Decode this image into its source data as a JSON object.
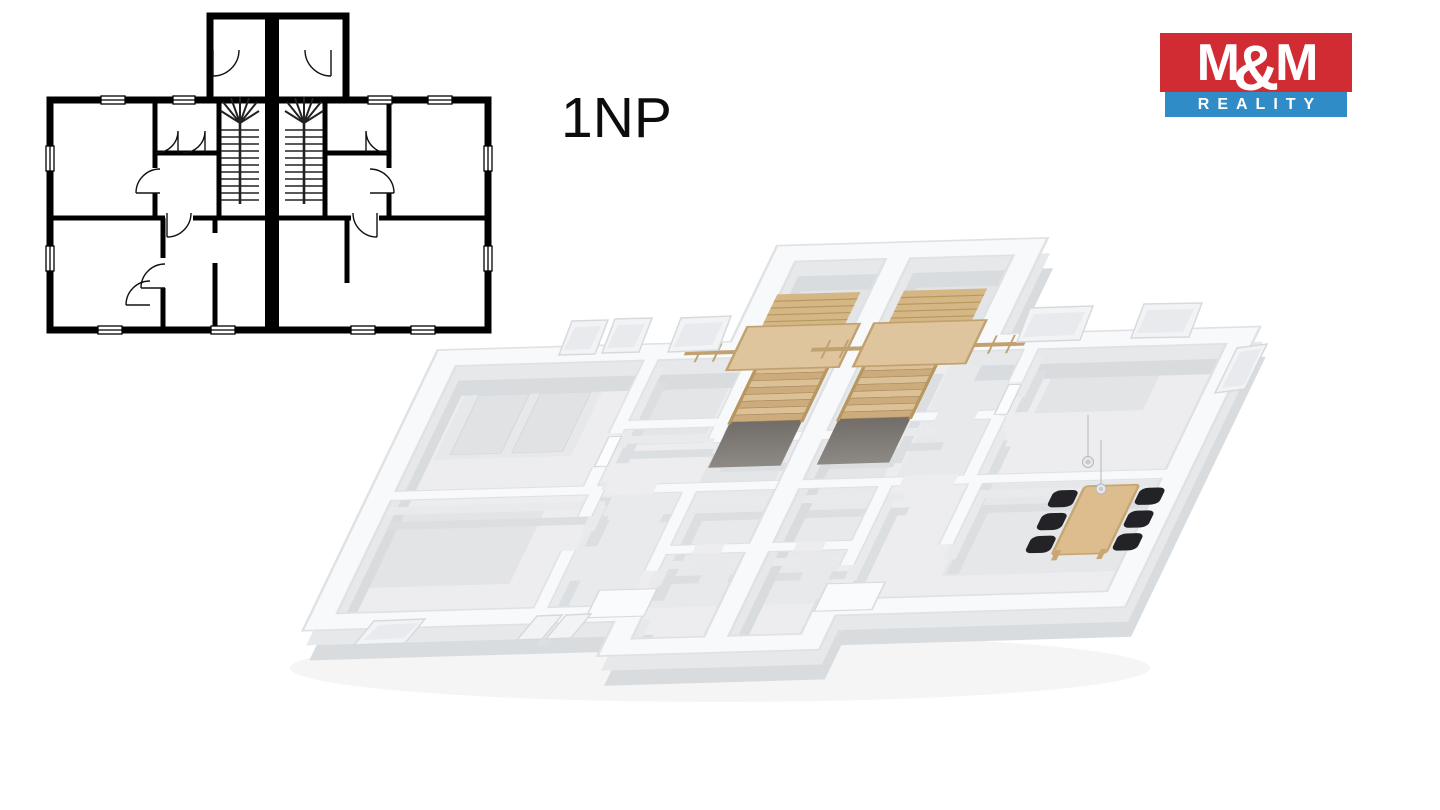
{
  "page": {
    "background": "#ffffff",
    "kind": "real-estate floor plan sheet"
  },
  "floor_label": "1NP",
  "logo": {
    "m1": "M",
    "amp": "&",
    "m2": "M",
    "reality": "REALITY",
    "red": "#d12b33",
    "blue": "#2f8cc7",
    "text_color": "#ffffff"
  },
  "floorplan_2d": {
    "label": "2D line floor plan of first floor (1NP), mirrored duplex",
    "line_color": "#000000",
    "features": [
      "rear entry protrusion with two vestibules",
      "thick central party wall",
      "two mirrored winder staircases with fan treads",
      "door swing arcs",
      "window symbols on exterior walls"
    ]
  },
  "floorplan_3d": {
    "label": "3D cutaway render of first floor (1NP), mirrored duplex",
    "colors": {
      "wall_top": "#f8f9fa",
      "wall_face": "#dcdfe2",
      "floor": "#ededef",
      "rug": "#e2e3e5",
      "wood_light": "#dfc59d",
      "wood_tread": "#d7b98b",
      "stair_void": "#54504b",
      "chair": "#232327",
      "table": "#ddbd8e"
    },
    "features": [
      "two mirrored wooden staircases with landings and railings",
      "rear entry halls",
      "central block of small bathrooms",
      "dining table with six black chairs",
      "two pendant lights",
      "tilted white window frames on rear and front walls"
    ]
  }
}
